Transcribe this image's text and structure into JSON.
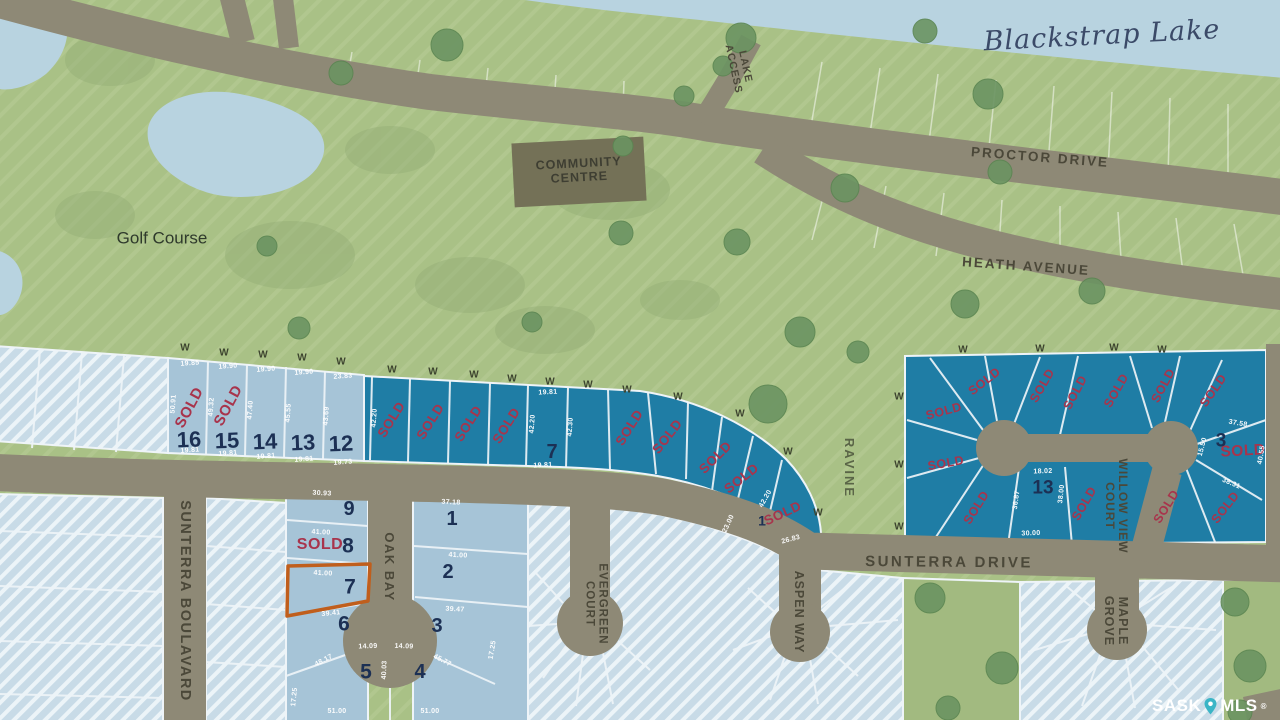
{
  "map": {
    "lake_name": "Blackstrap Lake",
    "golf_course": "Golf Course",
    "ravine": "RAVINE",
    "lake_access_1": "LAKE",
    "lake_access_2": "ACCESS",
    "community_1": "COMMUNITY",
    "community_2": "CENTRE",
    "sold": "SOLD",
    "well": "W"
  },
  "streets": {
    "proctor": "PROCTOR DRIVE",
    "heath": "HEATH AVENUE",
    "sunterra_drive": "SUNTERRA DRIVE",
    "sunterra_boulavard": "SUNTERRA BOULAVARD",
    "oak_bay": "OAK BAY",
    "evergreen_1": "EVERGREEN",
    "evergreen_2": "COURT",
    "aspen": "ASPEN WAY",
    "willow_1": "WILLOW VIEW",
    "willow_2": "COURT",
    "maple_1": "MAPLE",
    "maple_2": "GROVE"
  },
  "lot_numbers": {
    "strip": [
      "16",
      "15",
      "14",
      "13",
      "12"
    ],
    "teal": [
      "7",
      "1"
    ],
    "oak_west": [
      "9",
      "8",
      "7",
      "6",
      "5"
    ],
    "oak_east": [
      "1",
      "2",
      "3",
      "4"
    ],
    "right": [
      "13",
      "3"
    ]
  },
  "dims": {
    "strip_top": [
      "19.85",
      "19.90",
      "19.90",
      "19.90",
      "23.83"
    ],
    "strip_bottom": [
      "19.81",
      "19.81",
      "19.81",
      "19.81",
      "19.73"
    ],
    "strip_side": [
      "50.91",
      "49.32",
      "47.40",
      "45.55",
      "43.69"
    ],
    "teal": [
      "42.20",
      "19.81",
      "42.20",
      "42.30",
      "19.81",
      "42.20",
      "23.00",
      "26.83"
    ],
    "oak_west": [
      "30.93",
      "41.00",
      "41.00",
      "39.41",
      "14.09",
      "14.09",
      "48.17",
      "45.77",
      "51.00",
      "51.00",
      "17.25",
      "17.25",
      "40.03"
    ],
    "oak_east": [
      "37.18",
      "41.00",
      "39.47"
    ],
    "right_13": [
      "18.02",
      "30.00",
      "36.87",
      "38.00"
    ],
    "right_3": [
      "37.58",
      "15.50",
      "38.31",
      "40.55"
    ]
  },
  "watermark": {
    "sask": "SASK",
    "mls": "MLS",
    "reg": "®"
  },
  "colors": {
    "sold_red": "#a8344c",
    "teal_lot": "#1f7da5",
    "light_lot": "#a6c4d7",
    "hatch_lot": "#c8dbe7",
    "road": "#8e8976",
    "green": "#a9c186",
    "lake": "#b8d3e0",
    "highlight": "#c05e1c"
  }
}
